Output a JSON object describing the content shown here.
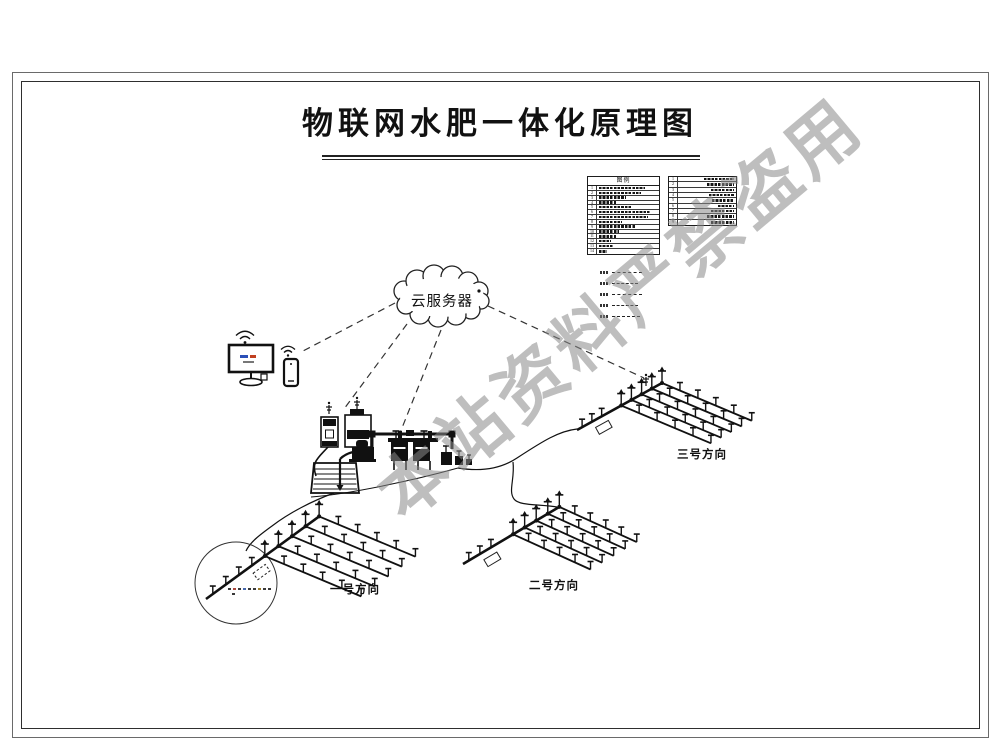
{
  "title": "物联网水肥一体化原理图",
  "watermark": "本站资料严禁盗用",
  "cloud_label": "云服务器",
  "legend": {
    "title": "图例",
    "left_rows": [
      {
        "no": "1",
        "w": 80
      },
      {
        "no": "2",
        "w": 72
      },
      {
        "no": "3",
        "w": 46
      },
      {
        "no": "4",
        "w": 30
      },
      {
        "no": "5",
        "w": 56
      },
      {
        "no": "6",
        "w": 88
      },
      {
        "no": "7",
        "w": 84
      },
      {
        "no": "8",
        "w": 40
      },
      {
        "no": "9",
        "w": 62
      },
      {
        "no": "10",
        "w": 34
      },
      {
        "no": "11",
        "w": 30
      },
      {
        "no": "12",
        "w": 20
      },
      {
        "no": "13",
        "w": 26
      },
      {
        "no": "14",
        "w": 14
      }
    ],
    "right_rows": [
      {
        "no": "1",
        "w": 55
      },
      {
        "no": "2",
        "w": 50
      },
      {
        "no": "3",
        "w": 42
      },
      {
        "no": "4",
        "w": 46
      },
      {
        "no": "5",
        "w": 40
      },
      {
        "no": "6",
        "w": 30
      },
      {
        "no": "7",
        "w": 42
      },
      {
        "no": "8",
        "w": 50
      },
      {
        "no": "9",
        "w": 42
      }
    ],
    "line_samples": [
      {
        "len": 30
      },
      {
        "len": 26
      },
      {
        "len": 30
      },
      {
        "len": 26
      },
      {
        "len": 28
      }
    ]
  },
  "field_labels": {
    "one": "一号方向",
    "two": "二号方向",
    "three": "三号方向"
  },
  "colors": {
    "ink": "#111111",
    "watermark_gray": "#8a8a8a"
  }
}
